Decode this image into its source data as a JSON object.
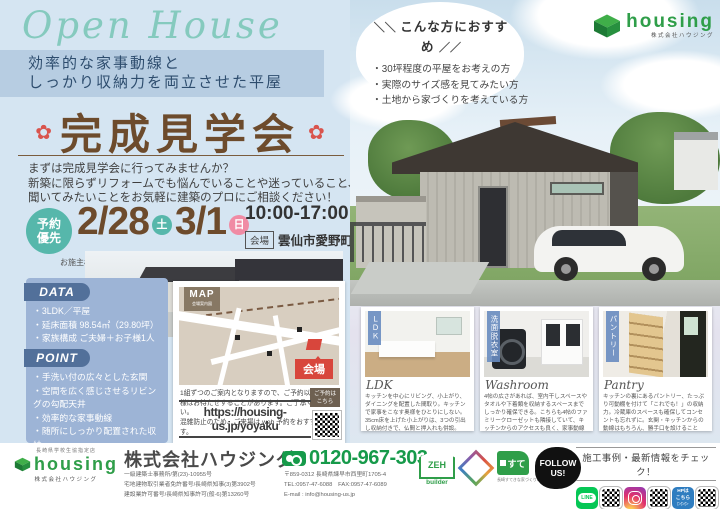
{
  "header": {
    "script_title": "Open House",
    "tagline_line1": "効率的な家事動線と",
    "tagline_line2": "しっかり収納力を両立させた平屋",
    "event_title": "完成見学会",
    "flower": "✿"
  },
  "intro": {
    "line1": "まずは完成見学会に行ってみませんか？",
    "line2": "新築に限らずリフォームでも悩んでいることや迷っていること、",
    "line3": "聞いてみたいことをお気軽に建築のプロにご相談ください！"
  },
  "recommend": {
    "decor_left": "＼＼",
    "decor_right": "／／",
    "title": "こんな方におすすめ",
    "items": [
      "30坪程度の平屋をお考えの方",
      "実際のサイズ感を見てみたい方",
      "土地から家づくりを考えている方"
    ]
  },
  "brand": {
    "name": "housing",
    "subtitle": "株式会社ハウジング"
  },
  "schedule": {
    "badge_line1": "予約",
    "badge_line2": "優先",
    "date1": "2/28",
    "day1": "土",
    "date2": "3/1",
    "day2": "日",
    "time": "10:00-17:00",
    "venue_label": "会場",
    "venue": "雲仙市愛野町",
    "note": "お施主様のご厚意により2日間に限り特別に公開いたします。"
  },
  "data_panel": {
    "title": "DATA",
    "items": [
      "3LDK／平屋",
      "延床面積 98.54㎡（29.80坪）",
      "家族構成 ご夫婦＋お子様1人"
    ]
  },
  "point_panel": {
    "title": "POINT",
    "items": [
      "手洗い付の広々とした玄関",
      "空間を広く感じさせるリビングの勾配天井",
      "効率的な家事動線",
      "随所にしっかり配置された収納"
    ]
  },
  "map_card": {
    "ribbon_title": "MAP",
    "ribbon_sub": "会場案内図",
    "venue_tag": "会場",
    "note_line1": "1組ずつのご案内となりますので、ご予約以外のお客",
    "note_line2": "様はお待たせすることがあります。ご了承ください。",
    "note_line3": "混雑防止のため、ご来場は web 予約をおすすめします。",
    "reserve_badge_line1": "ご予約は",
    "reserve_badge_line2": "こちら",
    "url": "https://housing-us.jp/yoyaku"
  },
  "interior_cards": [
    {
      "ribbon": "ＬＤＫ",
      "caption": "LDK",
      "description": "キッチンを中心にリビング、小上がり、ダイニングを配置した間取り。キッチンで家事をこなす奥様をひとりにしない。35cm床を上げた小上がりは、3つの引出し収納付きで、仏間と押入れも併設。"
    },
    {
      "ribbon": "洗面脱衣室",
      "caption": "Washroom",
      "description": "4帖の広さがあれば、室内干しスペースやタオルや下着類を収納するスペースまでしっかり確保できる。こちらも4帖のファミリークローゼットも隣接していて、キッチンからのアクセスも良く、家事動線もコンパクトになって◎"
    },
    {
      "ribbon": "パントリー",
      "caption": "Pantry",
      "description": "キッチンの裏にあるパントリー、たっぷり可動棚を付けて「これでも！」の収納力。冷蔵庫のスペースも確保してコンセントも忘れずに。玄関・キッチンからの動線はもちろん、勝手口を設けることで、買い物帰りやゴミ捨て時のストレスもなくなる算段。"
    }
  ],
  "footer": {
    "logo_caption": "長崎県学校生協指定店",
    "logo_name": "housing",
    "logo_sub": "株式会社ハウジング",
    "company": "株式会社ハウジング",
    "license1": "一級建築士事務所/第(23)-10955号",
    "license2": "宅地建物取引業者免許番号/長崎県知事(3)第3902号",
    "license3": "建設業許可番号/長崎県知事許可(般-6)第13260号",
    "phone": "0120-967-303",
    "address": "〒859-0312 長崎県諫早市西里町1705-4",
    "tel_fax": "TEL:0957-47-6088　FAX:0957-47-6089",
    "email": "E-mail : info@housing-us.jp",
    "zeh_text": "ZEH",
    "zeh_builder": "builder",
    "sute_text": "すて",
    "sute_caption": "長崎すてきな家づくりの会",
    "follow_line1": "FOLLOW",
    "follow_line2": "US!",
    "check_title": "施工事例・最新情報をチェック！",
    "line_label": "LINE",
    "hp_badge_line1": "HPは",
    "hp_badge_line2": "こちら",
    "hp_badge_line3": "▷▷▷"
  },
  "colors": {
    "accent_teal": "#56b7ab",
    "accent_pink": "#f08ba4",
    "title_brown": "#6d4b2c",
    "panel_blue": "#9db4d6",
    "brand_green": "#2f9e49",
    "alert_red": "#d8463c"
  }
}
